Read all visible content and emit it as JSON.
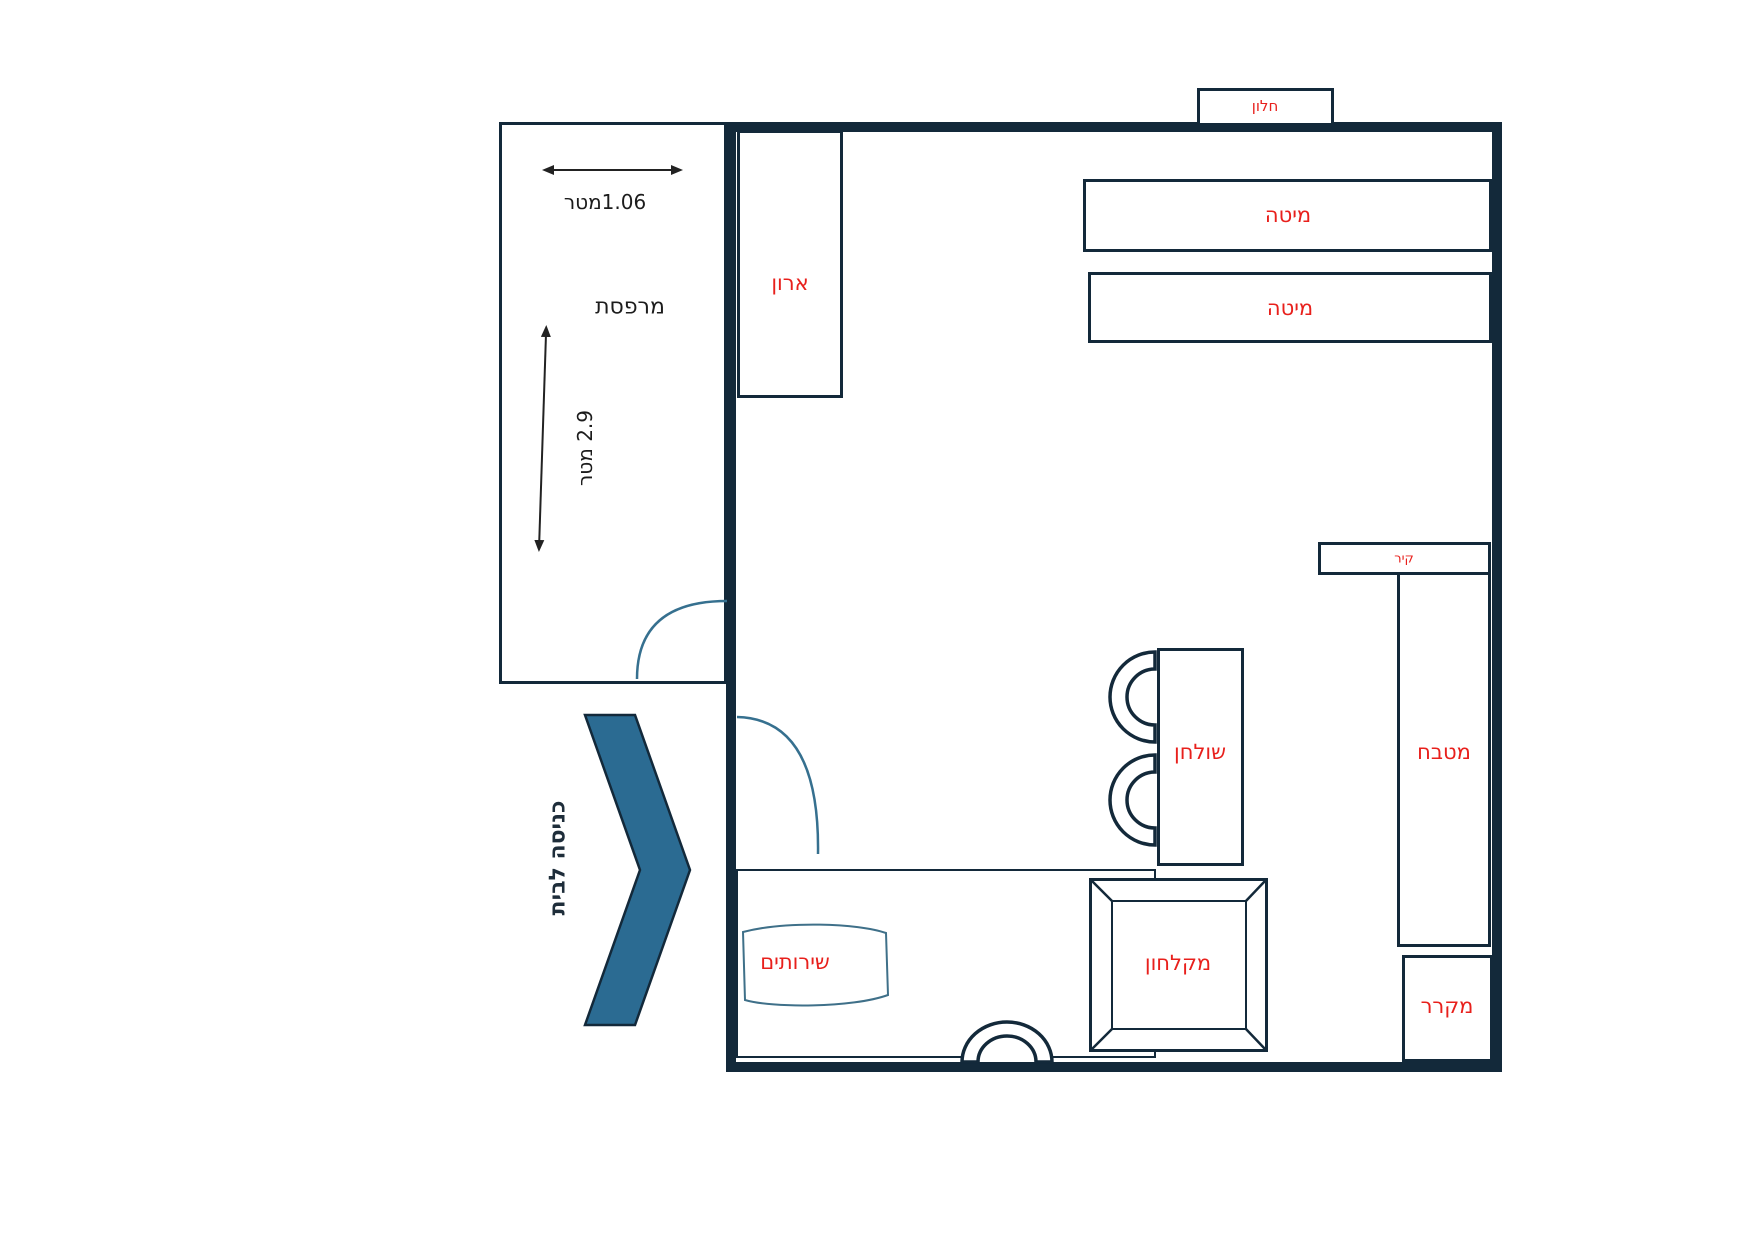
{
  "title": "apartment-floor-plan",
  "colors": {
    "wall": "#13293a",
    "label-red": "#e8201c",
    "chevron-blue": "#2b6b92",
    "door-arc": "#36708f",
    "text-dark": "#1c1c1c"
  },
  "labels": {
    "window": "חלון",
    "bed1": "מיטה",
    "bed2": "מיטה",
    "closet": "ארון",
    "balcony": "מרפסת",
    "balcony_width": "1.06מטר",
    "balcony_height": "2.9 מטר",
    "wall_unit": "קיר",
    "kitchen": "מטבח",
    "fridge": "מקרר",
    "table": "שולחן",
    "shower": "מקלחון",
    "toilet": "שירותים",
    "entrance": "כניסה לבית"
  }
}
